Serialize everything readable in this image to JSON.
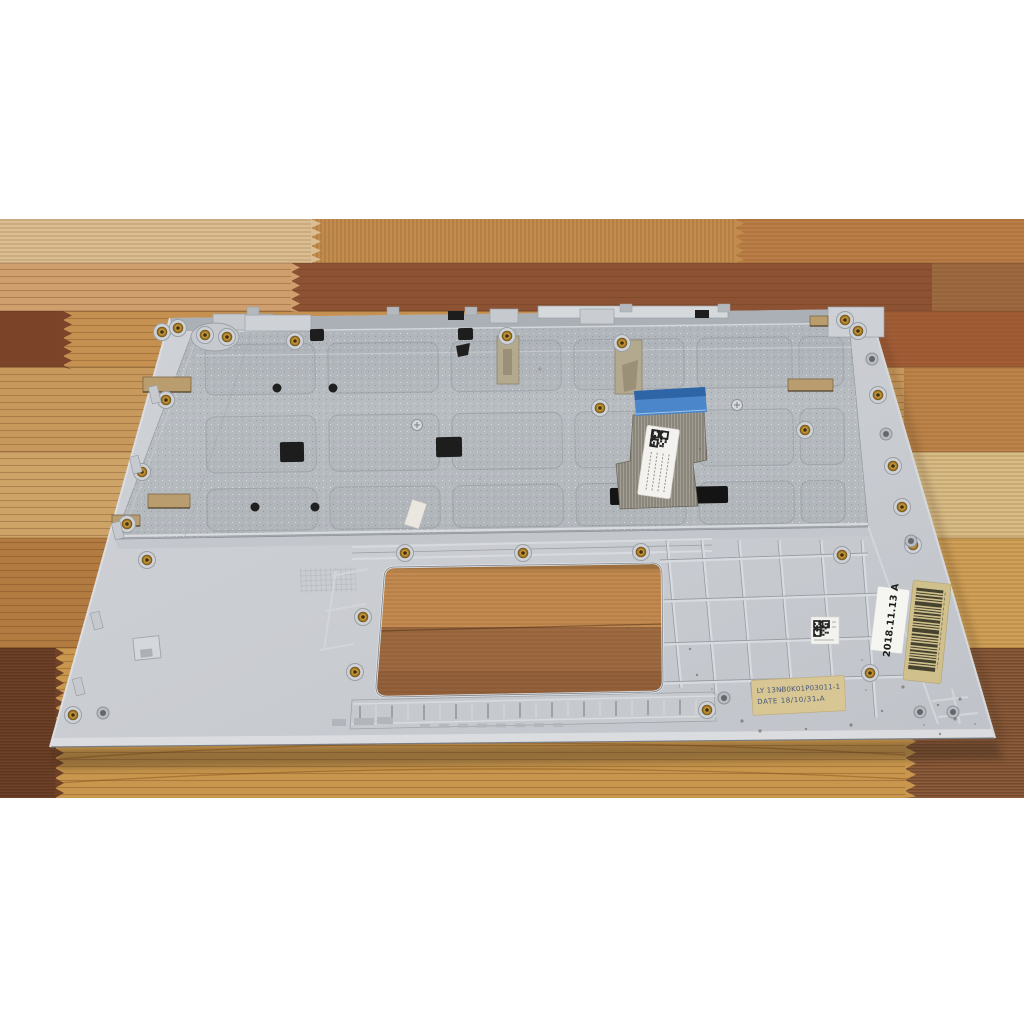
{
  "photo": {
    "alt": "Bottom side of a silver laptop palmrest keyboard assembly lying on a striped wooden table"
  },
  "stickers": {
    "date": {
      "text": "2018.11.13 A",
      "bg": "#f5f5f2",
      "text_color": "#1b1b1b"
    },
    "part_label": {
      "line1": "LY 13NB0K01P03011-1",
      "line2": "DATE 18/10/31 A",
      "bg": "#d8c794",
      "text_color": "#46567a"
    },
    "barcode": {
      "bg": "#cfc08c",
      "bar_color": "#2e2b20"
    },
    "qr_small": {
      "bg": "#f2f2ef"
    },
    "cable_label": {
      "bg": "#f3f2ee"
    }
  },
  "colors": {
    "background": "#ffffff",
    "palmrest_plastic": "#c9ccd1",
    "keyboard_plate": "#b6bbc0",
    "cable_connector_blue": "#4a86c9",
    "brass_insert": "#b98d36",
    "wood_light": "#dabe91",
    "wood_orange": "#c48f46",
    "wood_dark_brown": "#8c5233",
    "wood_golden": "#c8964c"
  }
}
